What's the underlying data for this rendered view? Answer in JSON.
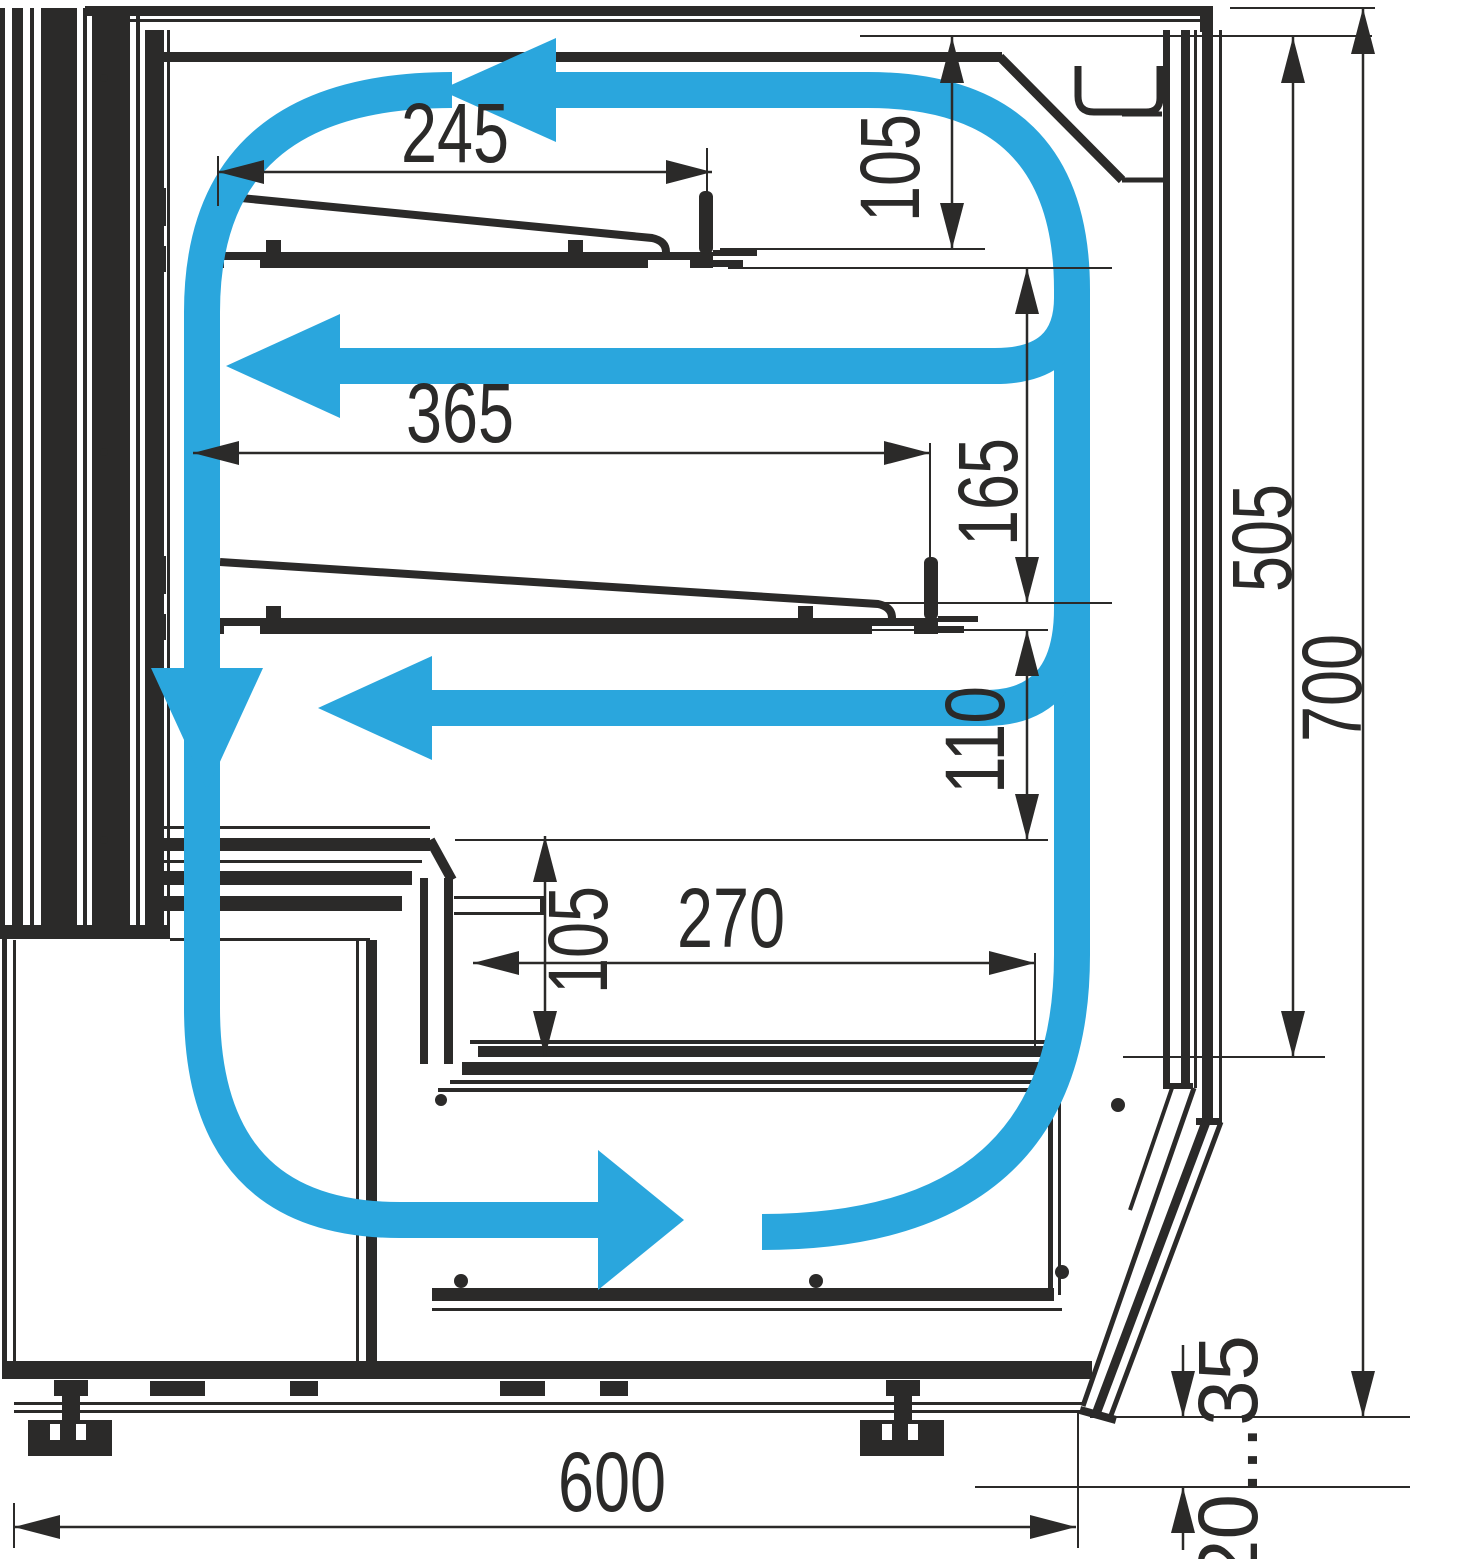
{
  "diagram": {
    "type": "technical-cross-section",
    "subject": "refrigerated display case airflow scheme",
    "accent_color": "#2aa6dd",
    "line_color": "#2b2a29",
    "dimensions": {
      "top_shelf_depth": "245",
      "top_air_gap": "105",
      "middle_shelf_depth": "365",
      "shelf_to_shelf_gap": "165",
      "glass_inner_height": "505",
      "overall_height": "700",
      "under_shelf_gap": "110",
      "well_rim_height": "105",
      "well_depth": "270",
      "base_depth": "600",
      "foot_adjust_range": "20...35"
    }
  }
}
